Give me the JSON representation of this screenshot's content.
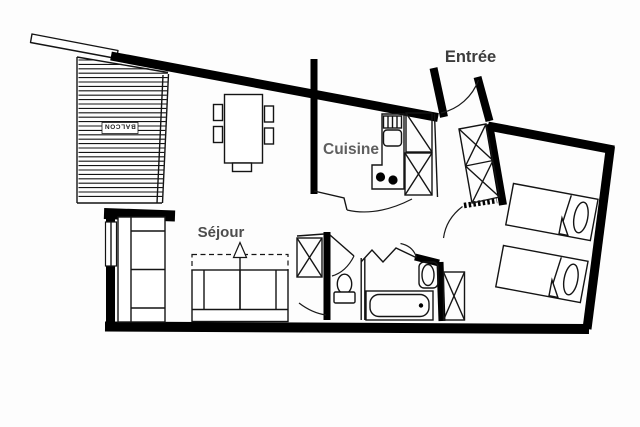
{
  "title": "Apartment floor plan",
  "colors": {
    "background": "#fdfdfd",
    "wall": "#000000",
    "furniture_line": "#141414",
    "label_dark": "#3d3d3d",
    "label_gray": "#5f5f5f"
  },
  "labels": {
    "entree": "Entrée",
    "cuisine": "Cuisine",
    "sejour": "Séjour",
    "balcon": "BALCON"
  }
}
